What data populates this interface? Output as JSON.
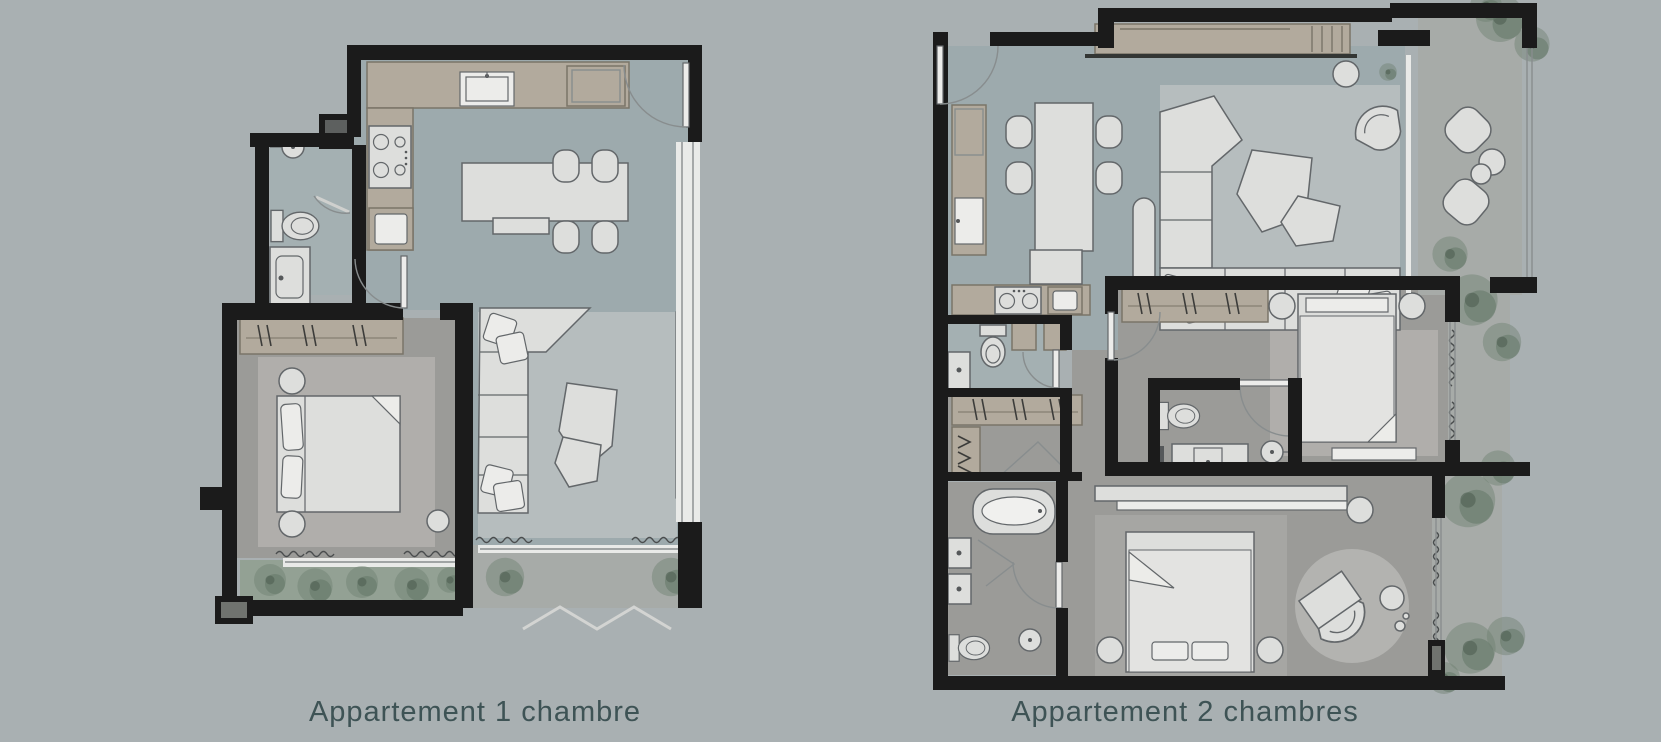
{
  "page": {
    "background_color": "#a9b0b2",
    "width_px": 1661,
    "height_px": 742
  },
  "plans": [
    {
      "id": "plan-1-bedroom",
      "caption": "Appartement 1 chambre"
    },
    {
      "id": "plan-2-bedrooms",
      "caption": "Appartement 2 chambres"
    }
  ],
  "palette": {
    "wall": "#1b1b1b",
    "floor_main": "#9daaad",
    "floor_bath": "#a4b0b2",
    "floor_bedroom": "#9b9b98",
    "floor_balcony": "#a7aba8",
    "rug_living": "#b6bdbe",
    "rug_bedroom": "#b0aeab",
    "furniture": "#dddedc",
    "furniture_outline": "#63676a",
    "cabinet": "#b2aa9d",
    "cabinet_outline": "#7a7468",
    "greenery": "#6e8171",
    "planter": "#93a194",
    "caption_text": "#3e5355",
    "page_bg": "#a9b0b2",
    "window_strip": "#e9eae8"
  }
}
